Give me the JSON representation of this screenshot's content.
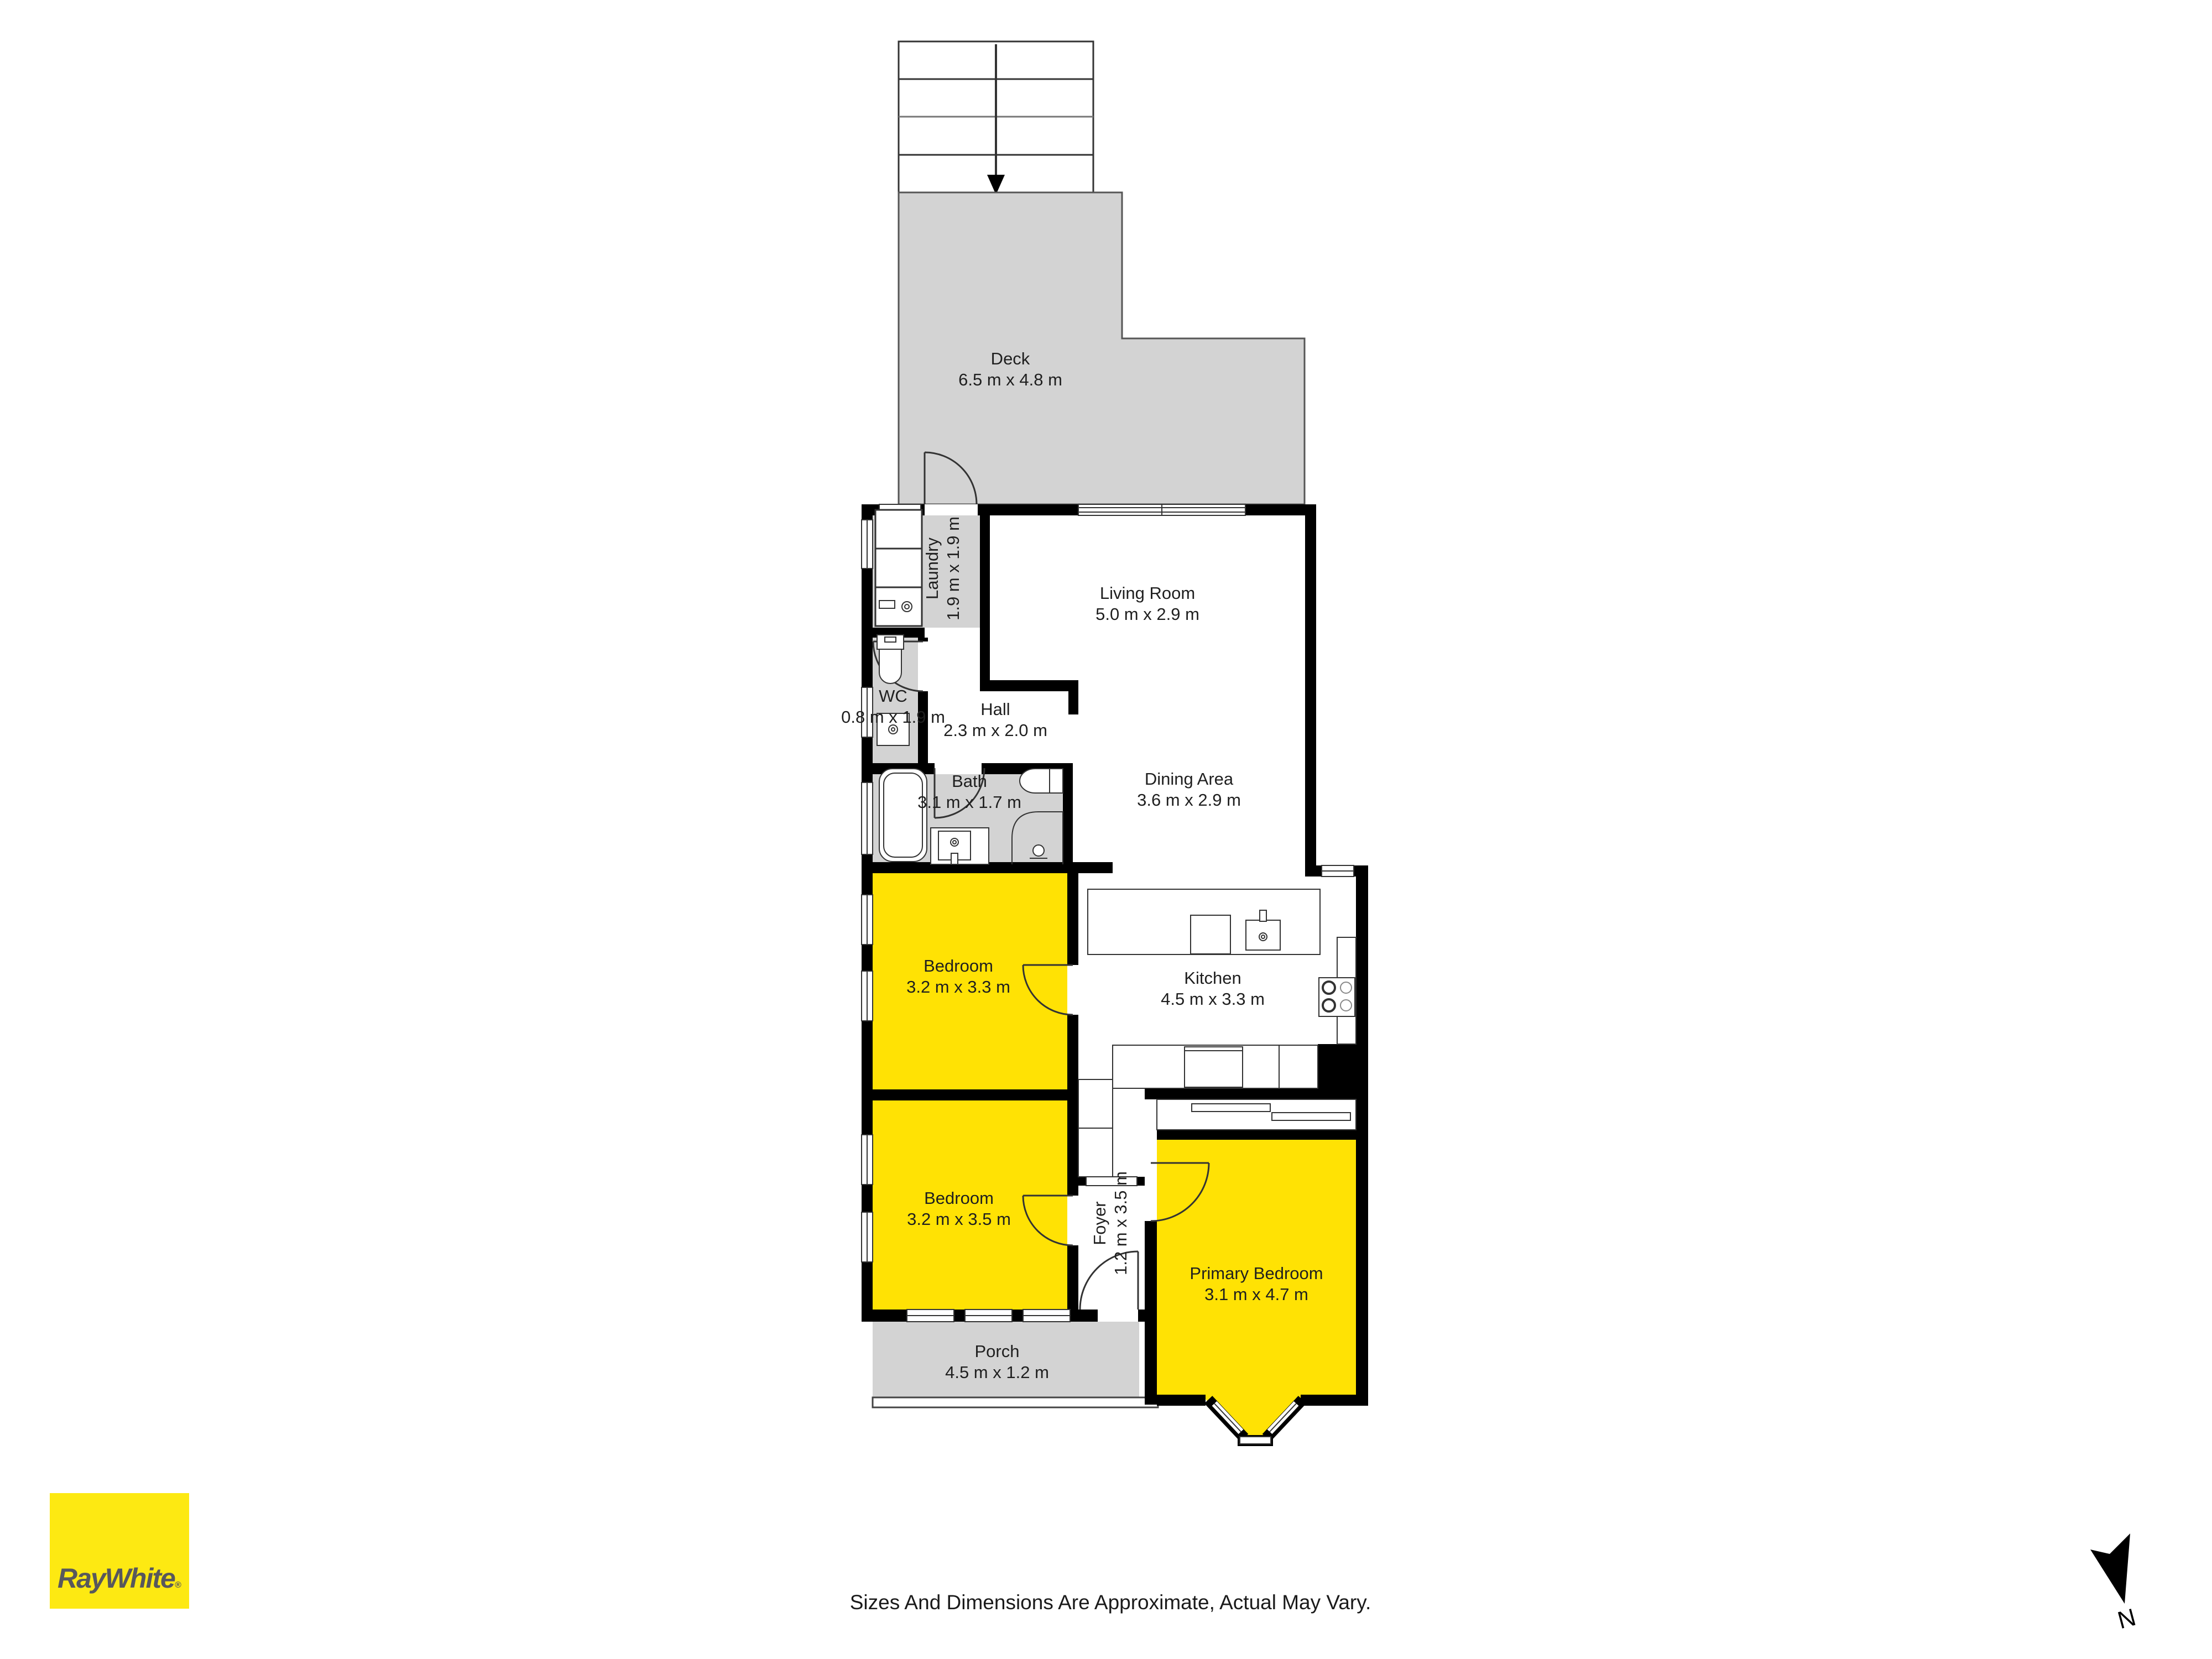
{
  "plan": {
    "rooms": [
      {
        "id": "deck",
        "name": "Deck",
        "dims": "6.5 m x 4.8 m"
      },
      {
        "id": "laundry",
        "name": "Laundry",
        "dims": "1.9 m x 1.9 m"
      },
      {
        "id": "living-room",
        "name": "Living Room",
        "dims": "5.0 m x 2.9 m"
      },
      {
        "id": "wc",
        "name": "WC",
        "dims": "0.8 m x 1.9 m"
      },
      {
        "id": "hall",
        "name": "Hall",
        "dims": "2.3 m x 2.0 m"
      },
      {
        "id": "bath",
        "name": "Bath",
        "dims": "3.1 m x 1.7 m"
      },
      {
        "id": "dining-area",
        "name": "Dining Area",
        "dims": "3.6 m x 2.9 m"
      },
      {
        "id": "bedroom-1",
        "name": "Bedroom",
        "dims": "3.2 m x 3.3 m"
      },
      {
        "id": "kitchen",
        "name": "Kitchen",
        "dims": "4.5 m x 3.3 m"
      },
      {
        "id": "bedroom-2",
        "name": "Bedroom",
        "dims": "3.2 m x 3.5 m"
      },
      {
        "id": "foyer",
        "name": "Foyer",
        "dims": "1.2 m x 3.5 m"
      },
      {
        "id": "primary-bedroom",
        "name": "Primary Bedroom",
        "dims": "3.1 m x 4.7 m"
      },
      {
        "id": "porch",
        "name": "Porch",
        "dims": "4.5 m x 1.2 m"
      }
    ],
    "compass": {
      "label": "N"
    },
    "colors": {
      "highlight": "#ffe204",
      "area_gray": "#d3d3d3",
      "wall": "#000000",
      "line": "#333333",
      "logo_yellow": "#fde912",
      "logo_text": "#58585c"
    }
  },
  "branding": {
    "logo_text": "RayWhite",
    "logo_mark": "®"
  },
  "footer": {
    "disclaimer": "Sizes And Dimensions Are Approximate, Actual May Vary."
  }
}
